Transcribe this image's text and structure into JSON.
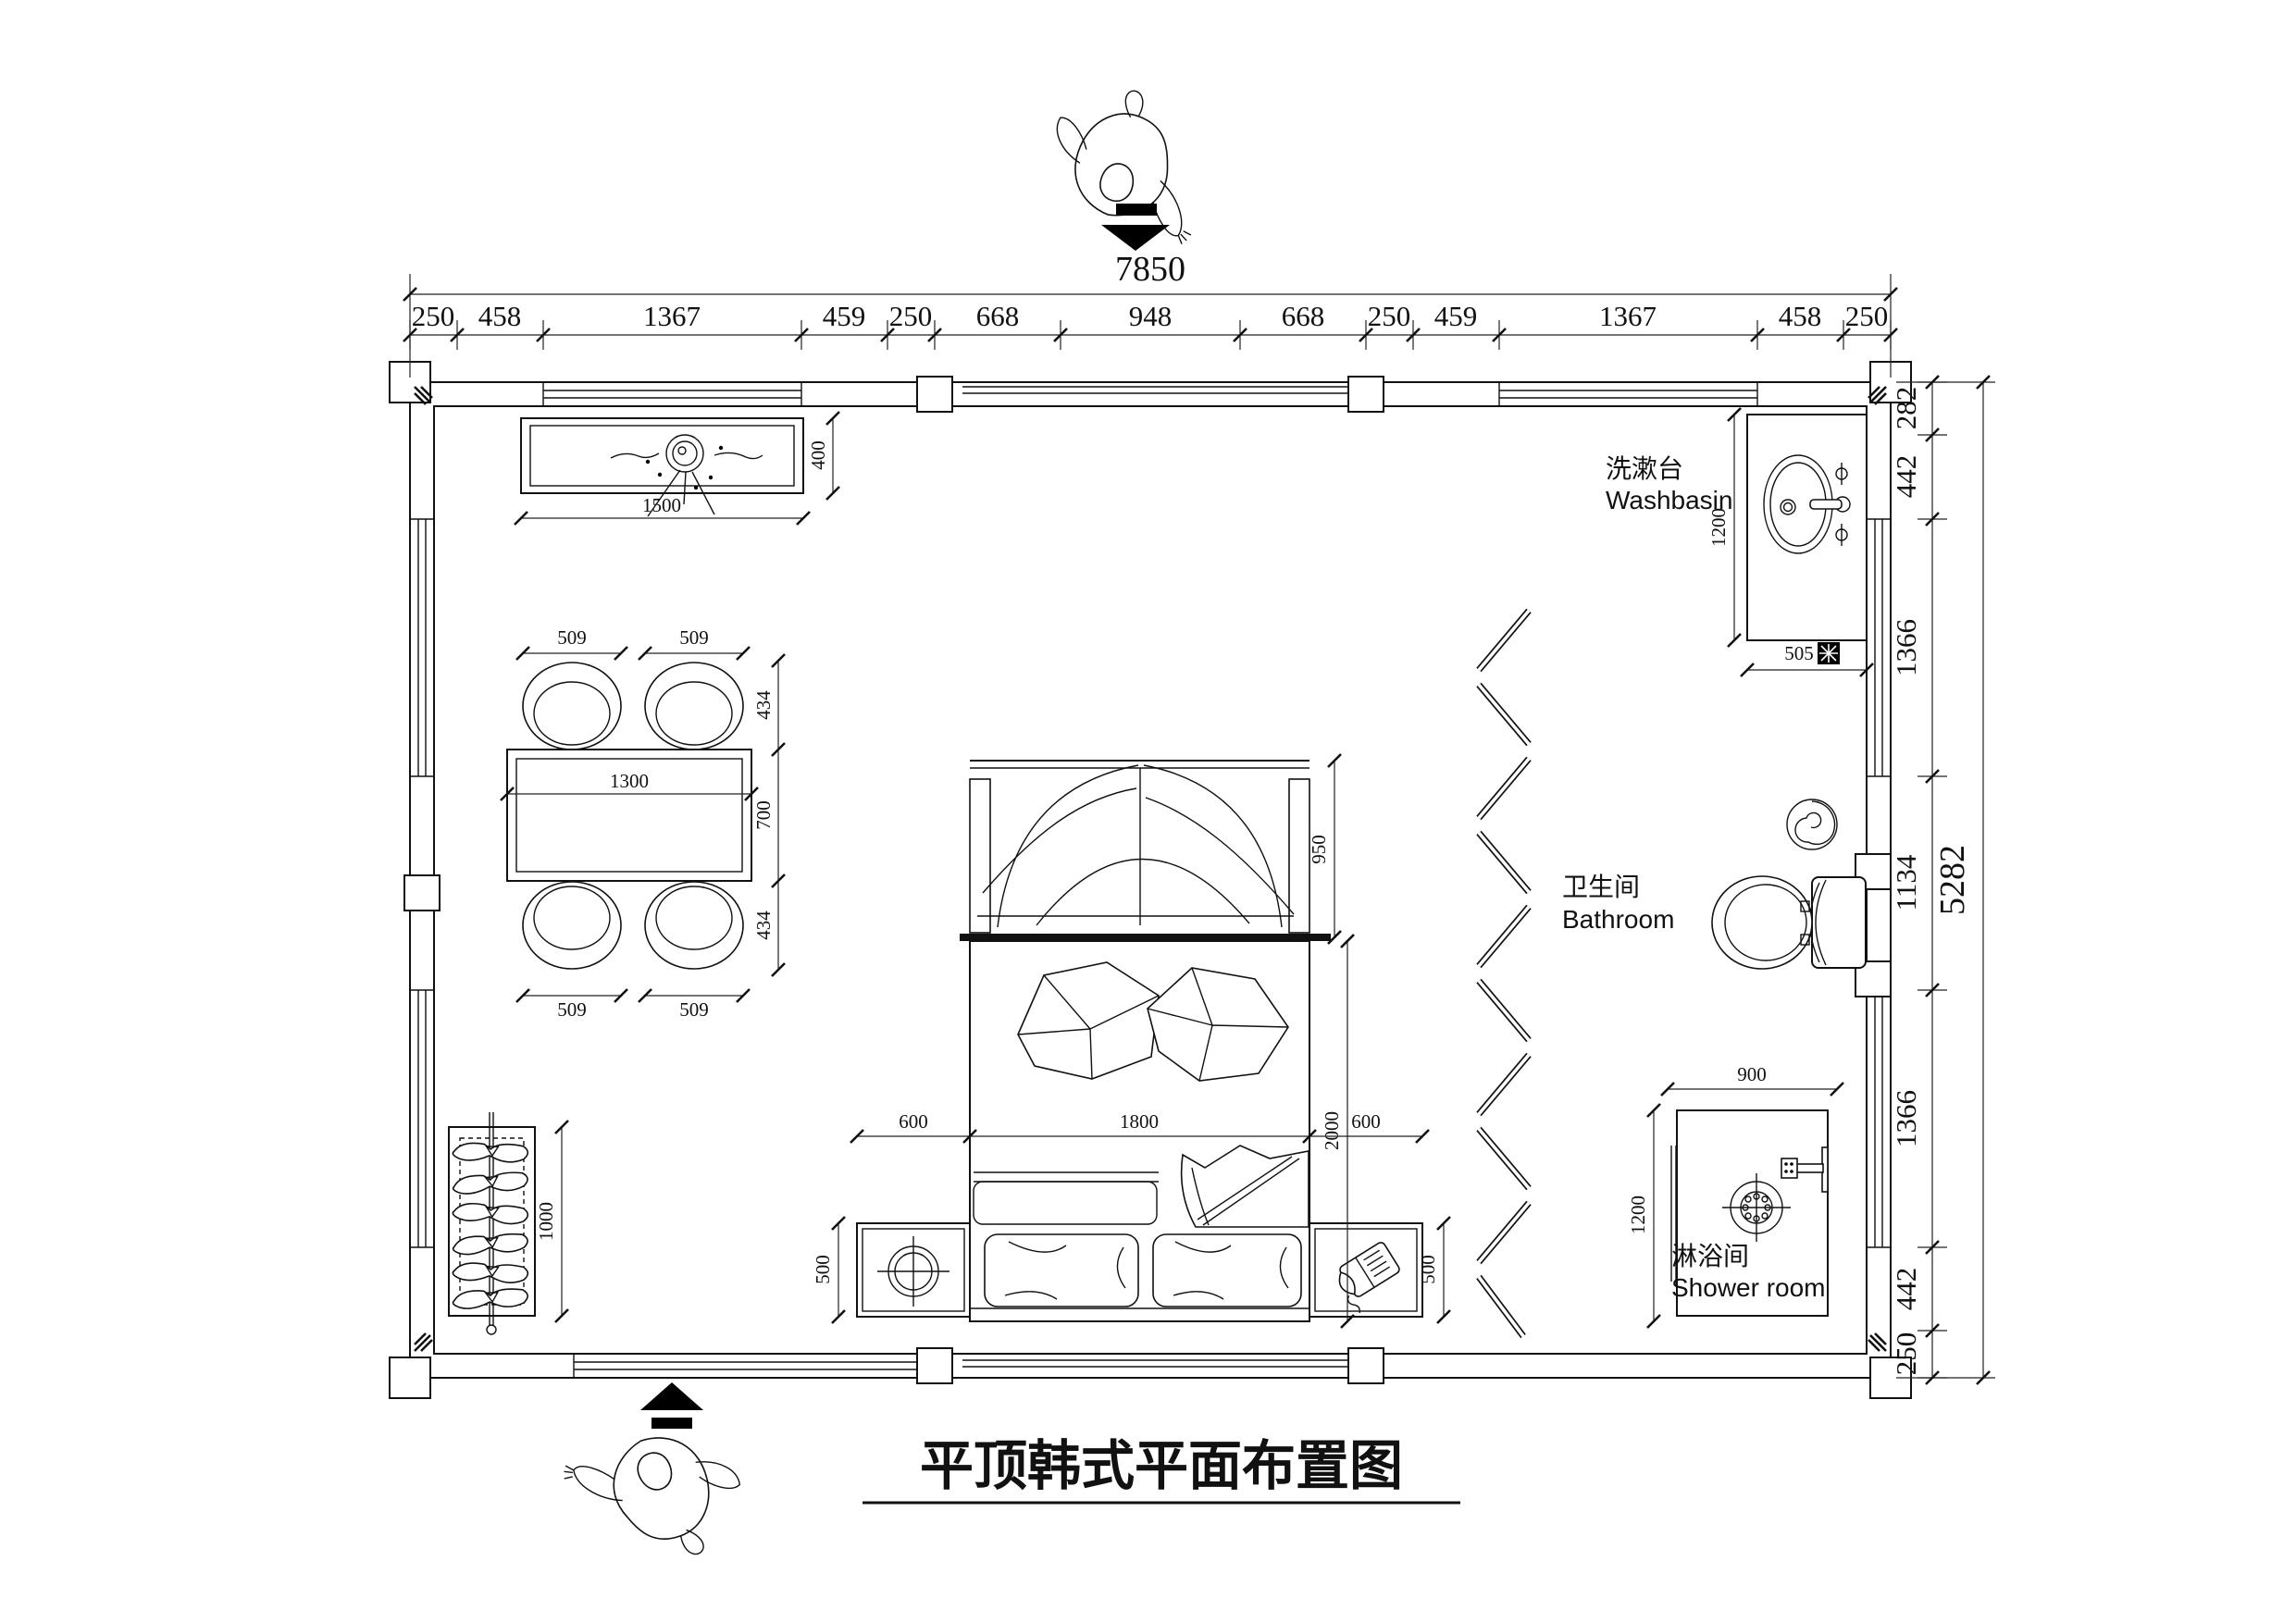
{
  "title": {
    "text": "平顶韩式平面布置图"
  },
  "dimensions": {
    "width_total": "7850",
    "height_total": "5282",
    "top_chain": [
      "250",
      "458",
      "1367",
      "459",
      "250",
      "668",
      "948",
      "668",
      "250",
      "459",
      "1367",
      "458",
      "250"
    ],
    "right_chain": [
      "282",
      "442",
      "1366",
      "1134",
      "1366",
      "442",
      "250"
    ]
  },
  "rooms": {
    "washbasin": {
      "cn": "洗漱台",
      "en": "Washbasin"
    },
    "bathroom": {
      "cn": "卫生间",
      "en": "Bathroom"
    },
    "shower": {
      "cn": "淋浴间",
      "en": "Shower room"
    }
  },
  "furniture_dims": {
    "counter_width": "1500",
    "counter_depth": "400",
    "chair_width": "509",
    "chair_depth": "434",
    "table_length": "1300",
    "table_width": "700",
    "rack_length": "1000",
    "canopy_depth": "950",
    "nightstand_width": "600",
    "bed_width": "1800",
    "bed_length": "2000",
    "nightstand_depth": "500",
    "basin_counter_length": "1200",
    "drain_offset": "505",
    "shower_width": "900",
    "shower_depth": "1200"
  }
}
